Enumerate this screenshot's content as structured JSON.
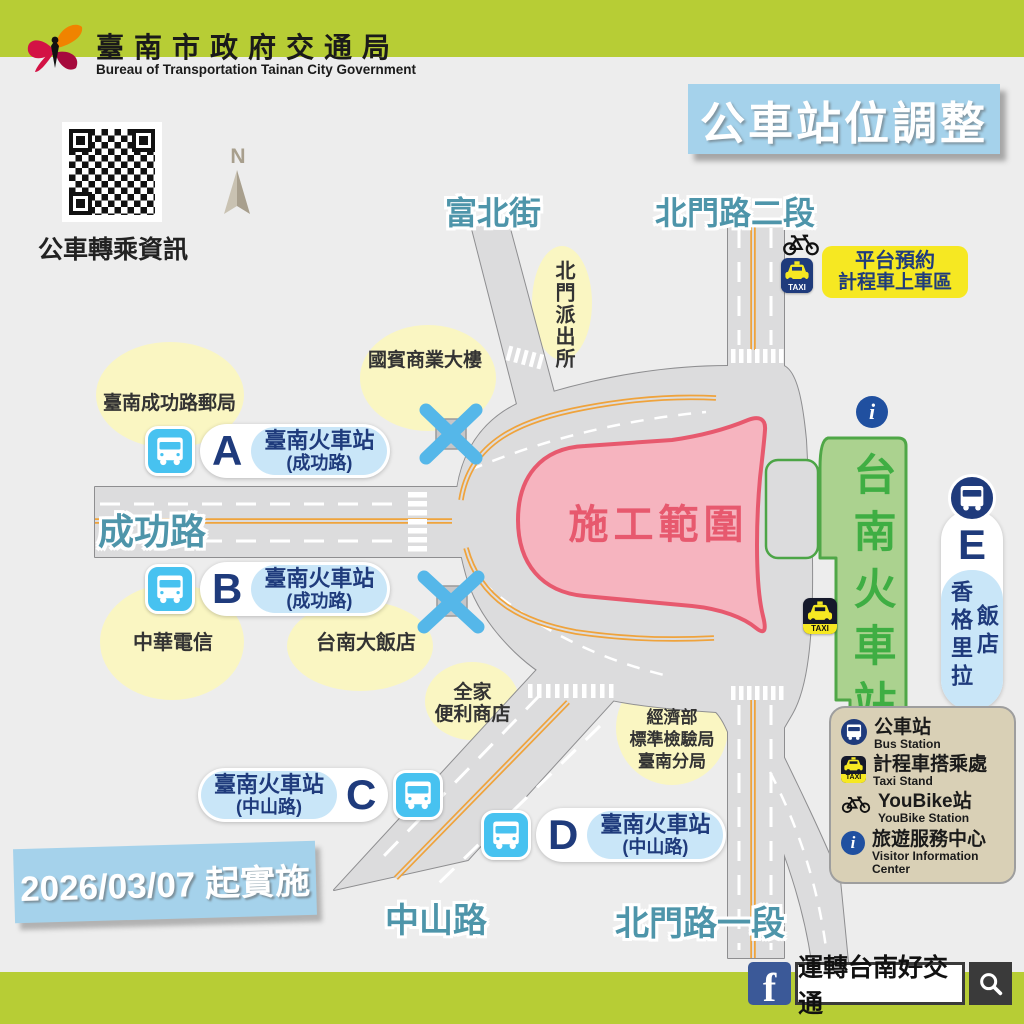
{
  "header": {
    "agency_zh": "臺南市政府交通局",
    "agency_en": "Bureau of Transportation Tainan City Government"
  },
  "badge": {
    "title": "公車站位調整"
  },
  "qr": {
    "caption": "公車轉乘資訊"
  },
  "compass": {
    "label": "N"
  },
  "streets": {
    "fubei": "富北街",
    "beimen_2": "北門路二段",
    "chenggong": "成功路",
    "zhongshan": "中山路",
    "beimen_1": "北門路一段"
  },
  "places": {
    "post_office": "臺南成功路郵局",
    "guobin": "國賓商業大樓",
    "police": "北門派出所",
    "cht": "中華電信",
    "grand_hotel": "台南大飯店",
    "family_1": "全家",
    "family_2": "便利商店",
    "bsmi_1": "經濟部",
    "bsmi_2": "標準檢驗局",
    "bsmi_3": "臺南分局"
  },
  "construction": {
    "label": "施工範圍"
  },
  "station": {
    "name": "台南火車站"
  },
  "taxi_pickup": {
    "line1": "平台預約",
    "line2": "計程車上車區"
  },
  "taxi_label": "TAXI",
  "stops": [
    {
      "letter": "A",
      "name": "臺南火車站",
      "road": "(成功路)"
    },
    {
      "letter": "B",
      "name": "臺南火車站",
      "road": "(成功路)"
    },
    {
      "letter": "C",
      "name": "臺南火車站",
      "road": "(中山路)"
    },
    {
      "letter": "D",
      "name": "臺南火車站",
      "road": "(中山路)"
    },
    {
      "letter": "E",
      "name": "香格里拉",
      "name2": "飯店"
    }
  ],
  "legend": {
    "items": [
      {
        "zh": "公車站",
        "en": "Bus Station"
      },
      {
        "zh": "計程車搭乘處",
        "en": "Taxi Stand"
      },
      {
        "zh": "YouBike站",
        "en": "YouBike Station"
      },
      {
        "zh": "旅遊服務中心",
        "en": "Visitor Information Center"
      }
    ]
  },
  "effective": {
    "text": "2026/03/07 起實施"
  },
  "facebook": {
    "page_name": "運轉台南好交通"
  },
  "colors": {
    "brand_green": "#B7CD35",
    "badge_blue": "#A5D2EB",
    "navy": "#1F3B7C",
    "stop_blue": "#47C2F0",
    "construction_pink": "#F6B4BF",
    "construction_red": "#E7596E",
    "station_green": "#ABD28F",
    "road_gray": "#DCDCDD",
    "lane_orange": "#EFA33C",
    "taxi_yellow": "#F6E822",
    "legend_tan": "#D9D0B6",
    "street_teal": "#4E95AA"
  }
}
